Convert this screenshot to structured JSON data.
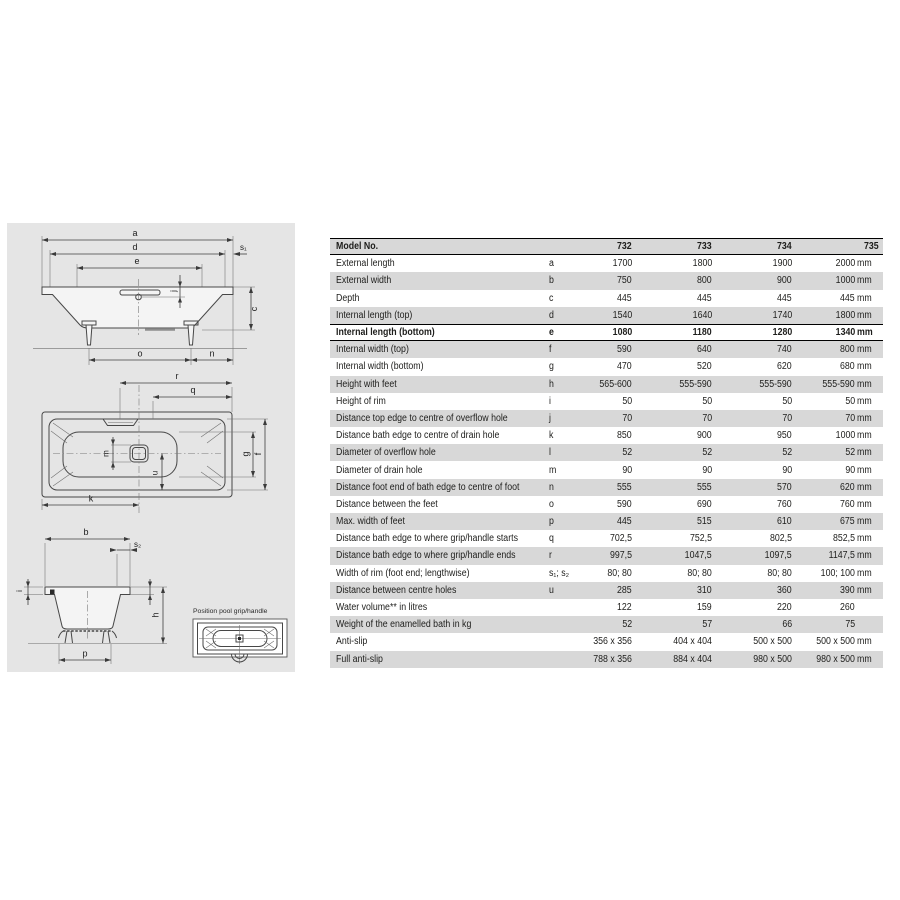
{
  "drawing": {
    "labels": {
      "a": "a",
      "d": "d",
      "e": "e",
      "s1": "s₁",
      "c": "c",
      "j": "j",
      "o": "o",
      "n": "n",
      "r": "r",
      "q": "q",
      "k": "k",
      "g": "g",
      "f": "f",
      "m": "m",
      "u": "u",
      "b": "b",
      "s2": "s₂",
      "h": "h",
      "p": "p",
      "i": "i"
    },
    "inset_caption": "Position pool grip/handle"
  },
  "table": {
    "header": {
      "label": "Model No.",
      "models": [
        "732",
        "733",
        "734",
        "735"
      ]
    },
    "rows": [
      {
        "label": "External length",
        "letter": "a",
        "values": [
          "1700",
          "1800",
          "1900",
          "2000"
        ],
        "unit": "mm"
      },
      {
        "label": "External width",
        "letter": "b",
        "values": [
          "750",
          "800",
          "900",
          "1000"
        ],
        "unit": "mm"
      },
      {
        "label": "Depth",
        "letter": "c",
        "values": [
          "445",
          "445",
          "445",
          "445"
        ],
        "unit": "mm"
      },
      {
        "label": "Internal length (top)",
        "letter": "d",
        "values": [
          "1540",
          "1640",
          "1740",
          "1800"
        ],
        "unit": "mm"
      },
      {
        "label": "Internal length (bottom)",
        "letter": "e",
        "values": [
          "1080",
          "1180",
          "1280",
          "1340"
        ],
        "unit": "mm",
        "bold": true
      },
      {
        "label": "Internal width (top)",
        "letter": "f",
        "values": [
          "590",
          "640",
          "740",
          "800"
        ],
        "unit": "mm"
      },
      {
        "label": "Internal width (bottom)",
        "letter": "g",
        "values": [
          "470",
          "520",
          "620",
          "680"
        ],
        "unit": "mm"
      },
      {
        "label": "Height with feet",
        "letter": "h",
        "values": [
          "565-600",
          "555-590",
          "555-590",
          "555-590"
        ],
        "unit": "mm"
      },
      {
        "label": "Height of rim",
        "letter": "i",
        "values": [
          "50",
          "50",
          "50",
          "50"
        ],
        "unit": "mm"
      },
      {
        "label": "Distance top edge to centre of overflow hole",
        "letter": "j",
        "values": [
          "70",
          "70",
          "70",
          "70"
        ],
        "unit": "mm"
      },
      {
        "label": "Distance bath edge to centre of drain hole",
        "letter": "k",
        "values": [
          "850",
          "900",
          "950",
          "1000"
        ],
        "unit": "mm"
      },
      {
        "label": "Diameter of overflow hole",
        "letter": "l",
        "values": [
          "52",
          "52",
          "52",
          "52"
        ],
        "unit": "mm"
      },
      {
        "label": "Diameter of drain hole",
        "letter": "m",
        "values": [
          "90",
          "90",
          "90",
          "90"
        ],
        "unit": "mm"
      },
      {
        "label": "Distance foot end of bath edge to centre of foot",
        "letter": "n",
        "values": [
          "555",
          "555",
          "570",
          "620"
        ],
        "unit": "mm"
      },
      {
        "label": "Distance between the feet",
        "letter": "o",
        "values": [
          "590",
          "690",
          "760",
          "760"
        ],
        "unit": "mm"
      },
      {
        "label": "Max. width of feet",
        "letter": "p",
        "values": [
          "445",
          "515",
          "610",
          "675"
        ],
        "unit": "mm"
      },
      {
        "label": "Distance bath edge to where grip/handle starts",
        "letter": "q",
        "values": [
          "702,5",
          "752,5",
          "802,5",
          "852,5"
        ],
        "unit": "mm"
      },
      {
        "label": "Distance bath edge to where grip/handle ends",
        "letter": "r",
        "values": [
          "997,5",
          "1047,5",
          "1097,5",
          "1147,5"
        ],
        "unit": "mm"
      },
      {
        "label": "Width of rim (foot end; lengthwise)",
        "letter": "s₁; s₂",
        "values": [
          "80; 80",
          "80; 80",
          "80; 80",
          "100; 100"
        ],
        "unit": "mm"
      },
      {
        "label": "Distance between centre holes",
        "letter": "u",
        "values": [
          "285",
          "310",
          "360",
          "390"
        ],
        "unit": "mm"
      },
      {
        "label": "Water volume** in litres",
        "letter": "",
        "values": [
          "122",
          "159",
          "220",
          "260"
        ],
        "unit": ""
      },
      {
        "label": "Weight of the enamelled bath in kg",
        "letter": "",
        "values": [
          "52",
          "57",
          "66",
          "75"
        ],
        "unit": ""
      },
      {
        "label": "Anti-slip",
        "letter": "",
        "values": [
          "356 x 356",
          "404 x 404",
          "500 x 500",
          "500 x 500"
        ],
        "unit": "mm"
      },
      {
        "label": "Full anti-slip",
        "letter": "",
        "values": [
          "788 x 356",
          "884 x 404",
          "980 x 500",
          "980 x 500"
        ],
        "unit": "mm"
      }
    ]
  },
  "colors": {
    "panel": "#e5e5e5",
    "stripe": "#d8d8d8",
    "text": "#1d1d1b",
    "line": "#474747"
  }
}
